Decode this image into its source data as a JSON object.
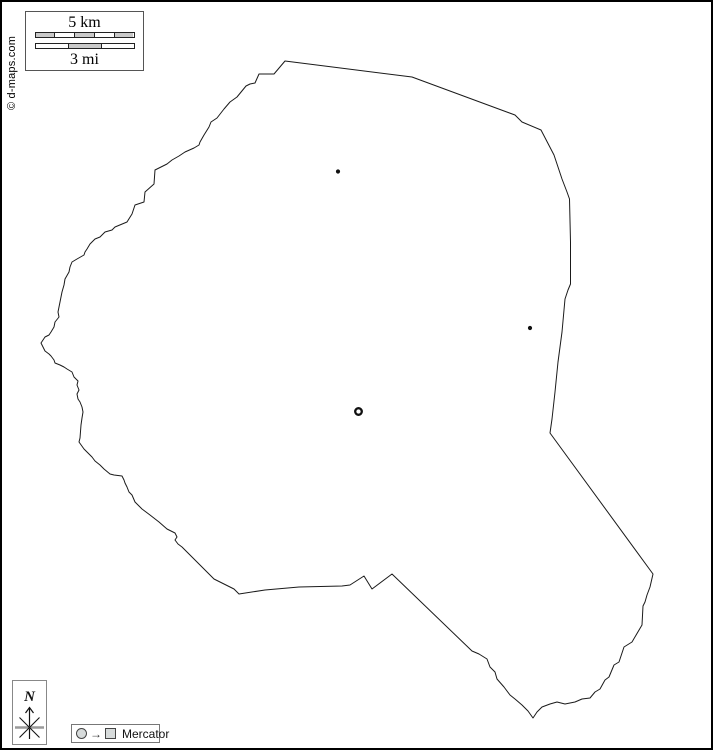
{
  "branding": {
    "copyright": "© d-maps.com"
  },
  "scale_box": {
    "km_label": "5 km",
    "mi_label": "3 mi",
    "km_fill_pattern": [
      "gray",
      "white",
      "gray",
      "white",
      "gray"
    ],
    "mi_fill_pattern": [
      "white",
      "gray",
      "white"
    ],
    "segment_gray": "#c9c9c9",
    "segment_white": "#ffffff"
  },
  "compass": {
    "north_label": "N"
  },
  "legend": {
    "projection_label": "Mercator"
  },
  "map": {
    "outline_stroke": "#1a1a1a",
    "marker_color": "#111111",
    "outline_points": [
      [
        283,
        59
      ],
      [
        410,
        75
      ],
      [
        513,
        113
      ],
      [
        520,
        120
      ],
      [
        539,
        128
      ],
      [
        552,
        153
      ],
      [
        560,
        177
      ],
      [
        565,
        190
      ],
      [
        567.5,
        197
      ],
      [
        568.5,
        240
      ],
      [
        568.5,
        282
      ],
      [
        566,
        288
      ],
      [
        563,
        297
      ],
      [
        560,
        330
      ],
      [
        556,
        360
      ],
      [
        553,
        390
      ],
      [
        550,
        417
      ],
      [
        548,
        431
      ],
      [
        651,
        572
      ],
      [
        648,
        585
      ],
      [
        645,
        593
      ],
      [
        643,
        600
      ],
      [
        641,
        604
      ],
      [
        640,
        623
      ],
      [
        630,
        640
      ],
      [
        622,
        645
      ],
      [
        617,
        660
      ],
      [
        612,
        663
      ],
      [
        607,
        675
      ],
      [
        603,
        678
      ],
      [
        598,
        687
      ],
      [
        593,
        690
      ],
      [
        588,
        696
      ],
      [
        580,
        697
      ],
      [
        573,
        700
      ],
      [
        563,
        702
      ],
      [
        555,
        700
      ],
      [
        548,
        702
      ],
      [
        540,
        705
      ],
      [
        535,
        710
      ],
      [
        531,
        716
      ],
      [
        526,
        709
      ],
      [
        520,
        703
      ],
      [
        513,
        697
      ],
      [
        508,
        693
      ],
      [
        502,
        685
      ],
      [
        495,
        677
      ],
      [
        493,
        670
      ],
      [
        488,
        665
      ],
      [
        485,
        657
      ],
      [
        477,
        652
      ],
      [
        470,
        649
      ],
      [
        390,
        572
      ],
      [
        370,
        587
      ],
      [
        362,
        574
      ],
      [
        348,
        583
      ],
      [
        340,
        584
      ],
      [
        297,
        585
      ],
      [
        263,
        588
      ],
      [
        237,
        592
      ],
      [
        232,
        587
      ],
      [
        222,
        582
      ],
      [
        212,
        577
      ],
      [
        205,
        570
      ],
      [
        198,
        563
      ],
      [
        190,
        555
      ],
      [
        185,
        550
      ],
      [
        180,
        545
      ],
      [
        176,
        542
      ],
      [
        173,
        538
      ],
      [
        175,
        535
      ],
      [
        173,
        531
      ],
      [
        165,
        527
      ],
      [
        157,
        520
      ],
      [
        148,
        513
      ],
      [
        140,
        507
      ],
      [
        133,
        500
      ],
      [
        130,
        493
      ],
      [
        127,
        490
      ],
      [
        125,
        485
      ],
      [
        123,
        481
      ],
      [
        122,
        478
      ],
      [
        120,
        474
      ],
      [
        112,
        473
      ],
      [
        108,
        472
      ],
      [
        102,
        467
      ],
      [
        98,
        463
      ],
      [
        93,
        459
      ],
      [
        90,
        455
      ],
      [
        85,
        450
      ],
      [
        82,
        447
      ],
      [
        77,
        440
      ],
      [
        78,
        436
      ],
      [
        79,
        423
      ],
      [
        80,
        416
      ],
      [
        81,
        410
      ],
      [
        80,
        405
      ],
      [
        78,
        400
      ],
      [
        76,
        397
      ],
      [
        75,
        392
      ],
      [
        77,
        388
      ],
      [
        75,
        383
      ],
      [
        76,
        379
      ],
      [
        72,
        375
      ],
      [
        70,
        370
      ],
      [
        65,
        367
      ],
      [
        62,
        365
      ],
      [
        58,
        363
      ],
      [
        53,
        361
      ],
      [
        52,
        358
      ],
      [
        49,
        354
      ],
      [
        47,
        352
      ],
      [
        43,
        349
      ],
      [
        41,
        345
      ],
      [
        39,
        341
      ],
      [
        41,
        338
      ],
      [
        43,
        335
      ],
      [
        47,
        333
      ],
      [
        49,
        330
      ],
      [
        52,
        325
      ],
      [
        53,
        320
      ],
      [
        57,
        315
      ],
      [
        56,
        310
      ],
      [
        58,
        300
      ],
      [
        60,
        290
      ],
      [
        62,
        283
      ],
      [
        63,
        277
      ],
      [
        67,
        270
      ],
      [
        68,
        265
      ],
      [
        70,
        260
      ],
      [
        75,
        257
      ],
      [
        82,
        253
      ],
      [
        83,
        250
      ],
      [
        85,
        247
      ],
      [
        88,
        242
      ],
      [
        93,
        237
      ],
      [
        98,
        235
      ],
      [
        103,
        230
      ],
      [
        110,
        228
      ],
      [
        113,
        225
      ],
      [
        125,
        220
      ],
      [
        130,
        212
      ],
      [
        133,
        203
      ],
      [
        142,
        200
      ],
      [
        143,
        190
      ],
      [
        152,
        182
      ],
      [
        153,
        168
      ],
      [
        165,
        162
      ],
      [
        170,
        158
      ],
      [
        177,
        154
      ],
      [
        183,
        150
      ],
      [
        192,
        146
      ],
      [
        197,
        143
      ],
      [
        198,
        140
      ],
      [
        202,
        133
      ],
      [
        207,
        125
      ],
      [
        209,
        120
      ],
      [
        215,
        116
      ],
      [
        222,
        107
      ],
      [
        228,
        100
      ],
      [
        235,
        95
      ],
      [
        244,
        84
      ],
      [
        248,
        82
      ],
      [
        253,
        81
      ],
      [
        257,
        72
      ],
      [
        272,
        72
      ]
    ],
    "markers": [
      {
        "type": "dot",
        "x": 336,
        "y": 169.5,
        "r": 2.1
      },
      {
        "type": "dot",
        "x": 528,
        "y": 326,
        "r": 2.1
      },
      {
        "type": "ring",
        "x": 356.5,
        "y": 409.5,
        "r": 3.3,
        "stroke_width": 2.3
      }
    ]
  }
}
